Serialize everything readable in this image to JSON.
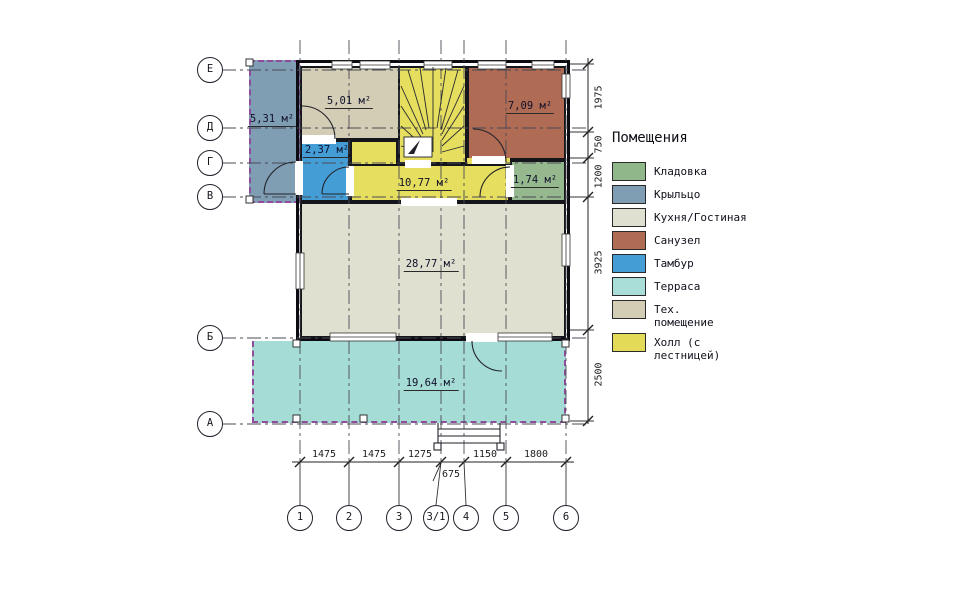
{
  "legend": {
    "title": "Помещения",
    "items": [
      {
        "label": "Кладовка",
        "color": "#8fb78a"
      },
      {
        "label": "Крыльцо",
        "color": "#7f9db3"
      },
      {
        "label": "Кухня/Гостиная",
        "color": "#dfe0d0"
      },
      {
        "label": "Санузел",
        "color": "#af6b53"
      },
      {
        "label": "Тамбур",
        "color": "#459dd6"
      },
      {
        "label": "Терраса",
        "color": "#a8ded7"
      },
      {
        "label": "Тех. помещение",
        "color": "#d2cdb4"
      },
      {
        "label": "Холл (с лестницей)",
        "color": "#e3da57"
      }
    ]
  },
  "rooms": {
    "kryltso": {
      "area": "5,31 м²",
      "color": "#7f9db3"
    },
    "tech": {
      "area": "5,01 м²",
      "color": "#d2cdb4"
    },
    "sanuzel": {
      "area": "7,09 м²",
      "color": "#af6b53"
    },
    "tambur": {
      "area": "2,37 м²",
      "color": "#459dd6"
    },
    "hall": {
      "area": "10,77 м²",
      "color": "#e5de5e"
    },
    "kladovka": {
      "area": "1,74 м²",
      "color": "#96b88e"
    },
    "kitchen": {
      "area": "28,77 м²",
      "color": "#dfe0d0"
    },
    "terrace": {
      "area": "19,64 м²",
      "color": "#a5dcd5"
    }
  },
  "axes": {
    "rows": [
      "Е",
      "Д",
      "Г",
      "В",
      "Б",
      "А"
    ],
    "cols": [
      "1",
      "2",
      "3",
      "3/1",
      "4",
      "5",
      "6"
    ]
  },
  "dimensions": {
    "bottom": [
      "1475",
      "1475",
      "1275",
      "1150",
      "1800"
    ],
    "bottom_offset": "675",
    "right": [
      "1975",
      "750",
      "1200",
      "3925",
      "2500"
    ]
  }
}
